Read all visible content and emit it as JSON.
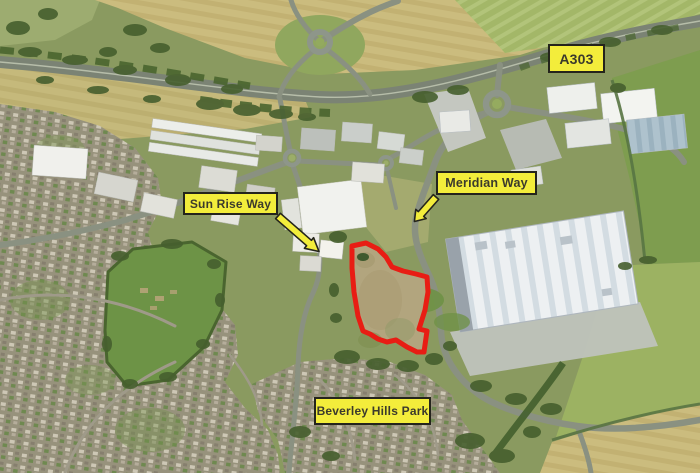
{
  "colors": {
    "label-bg": "#f3ed3b",
    "label-border": "#24241c",
    "label-text": "#3b3a2c",
    "site-outline": "#e81d14",
    "arrow-fill": "#f3ed3b",
    "arrow-outline": "#24241c"
  },
  "labels": {
    "a303": "A303",
    "sun_rise_way": "Sun Rise Way",
    "meridian_way": "Meridian Way",
    "beverley_hills_park": "Beverley Hills Park"
  },
  "site": {
    "outline_points": "352,246 366,243 378,249 386,257 392,267 403,271 416,274 427,277 428,292 425,310 419,329 427,331 424,352 417,352 407,347 396,340 387,342 378,339 370,334 363,331 358,316 354,292 352,268"
  }
}
